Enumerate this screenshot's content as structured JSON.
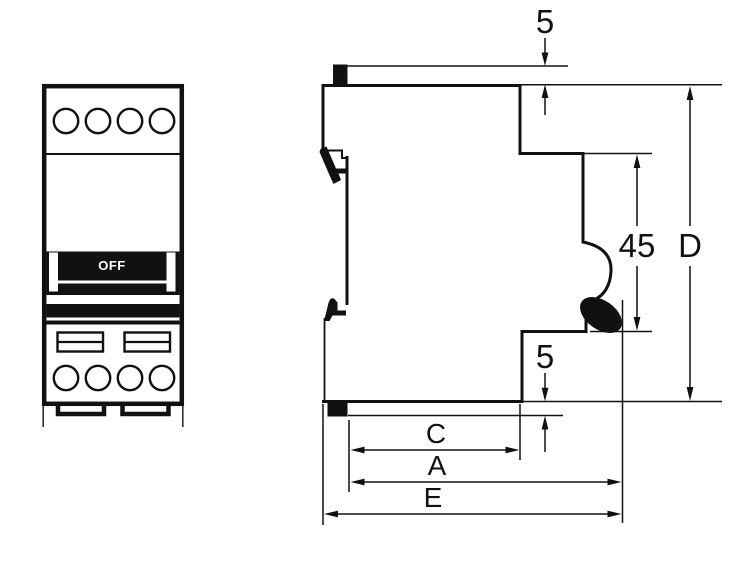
{
  "front_view": {
    "name": "circuit-breaker front view",
    "toggle_label": "OFF"
  },
  "dimensions": {
    "top_protrusion": "5",
    "front_height": "45",
    "overall_height": "D",
    "bottom_protrusion": "5",
    "depth_c": "C",
    "depth_a": "A",
    "depth_e": "E"
  },
  "colors": {
    "line": "#111111",
    "background": "#ffffff",
    "toggle_fill": "#000000",
    "toggle_text": "#ffffff"
  }
}
